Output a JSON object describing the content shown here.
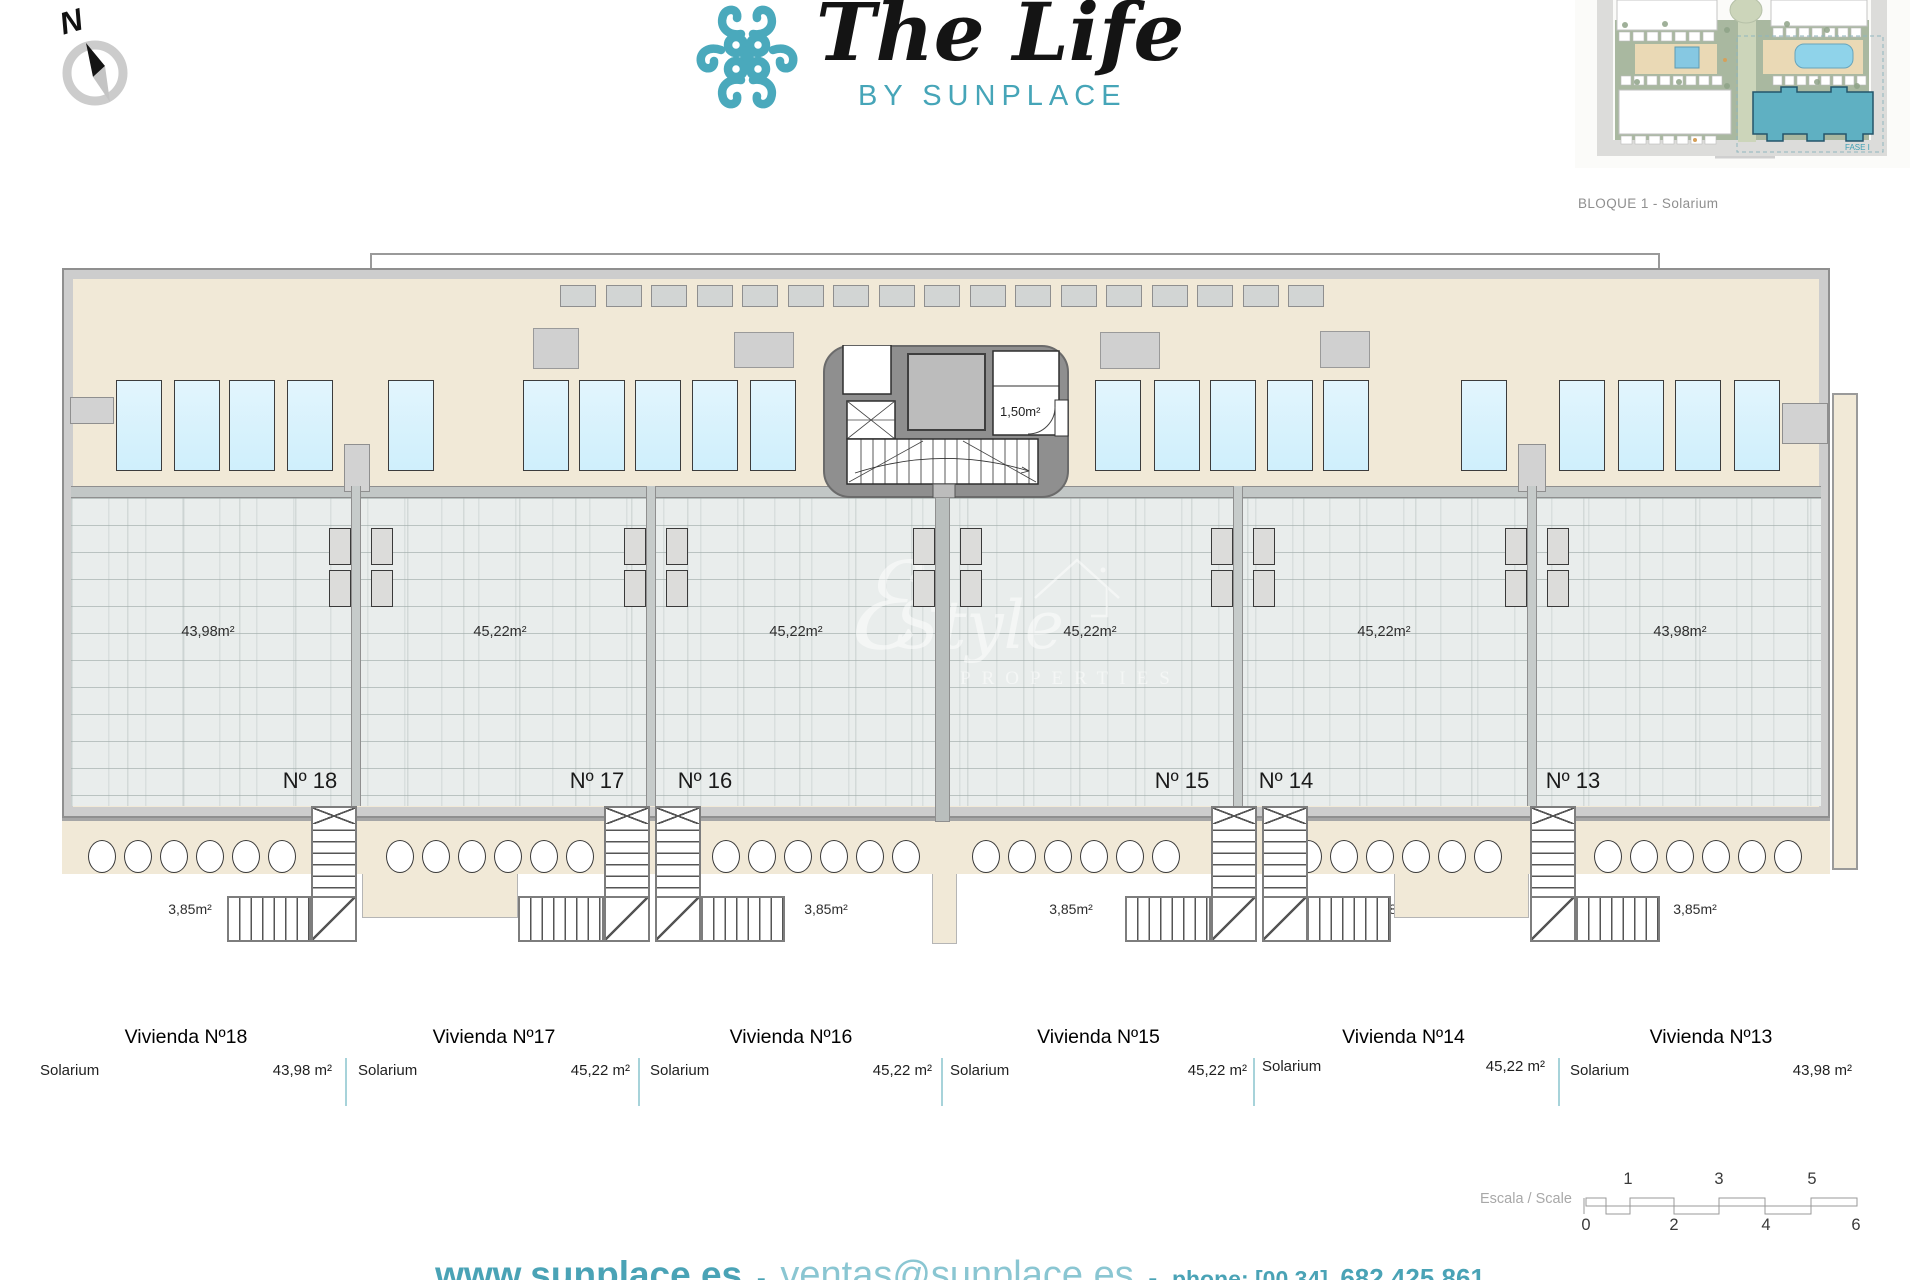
{
  "compass": {
    "label": "N"
  },
  "brand": {
    "title": "The Life",
    "subtitle": "BY SUNPLACE",
    "accent": "#4aa9bc"
  },
  "siteplan": {
    "caption": "BLOQUE 1 - Solarium",
    "fase_label": "FASE I",
    "highlight_color": "#5fb0c2"
  },
  "plan": {
    "core": {
      "aseo_area": "1,50m²"
    },
    "units": [
      {
        "number": "Nº 18",
        "area": "43,98m²",
        "stair_area": "3,85m²"
      },
      {
        "number": "Nº 17",
        "area": "45,22m²",
        "stair_area": "3,85m²"
      },
      {
        "number": "Nº 16",
        "area": "45,22m²",
        "stair_area": "3,85m²"
      },
      {
        "number": "Nº 15",
        "area": "45,22m²",
        "stair_area": "3,85m²"
      },
      {
        "number": "Nº 14",
        "area": "45,22m²",
        "stair_area": "3,85m²"
      },
      {
        "number": "Nº 13",
        "area": "43,98m²",
        "stair_area": "3,85m²"
      }
    ]
  },
  "watermark": {
    "monogram": "ℰ",
    "name": "Style",
    "sub": "PROPERTIES"
  },
  "table": {
    "rows": [
      {
        "title": "Vivienda Nº18",
        "label": "Solarium",
        "value": "43,98 m²"
      },
      {
        "title": "Vivienda Nº17",
        "label": "Solarium",
        "value": "45,22 m²"
      },
      {
        "title": "Vivienda Nº16",
        "label": "Solarium",
        "value": "45,22 m²"
      },
      {
        "title": "Vivienda Nº15",
        "label": "Solarium",
        "value": "45,22 m²"
      },
      {
        "title": "Vivienda Nº14",
        "label": "Solarium",
        "value": "45,22 m²"
      },
      {
        "title": "Vivienda Nº13",
        "label": "Solarium",
        "value": "43,98 m²"
      }
    ]
  },
  "scale": {
    "label": "Escala / Scale",
    "top_numbers": [
      "1",
      "3",
      "5"
    ],
    "bottom_numbers": [
      "0",
      "2",
      "4",
      "6"
    ]
  },
  "footer": {
    "website": "www.sunplace.es",
    "separator": "-",
    "email": "ventas@sunplace.es",
    "phone_label": "phone: [00 34]",
    "phone_number": "682 425 861"
  },
  "colors": {
    "accent_teal": "#4aa3b6",
    "beige": "#f1e9d7",
    "pool_blue": "#cfeffc"
  }
}
